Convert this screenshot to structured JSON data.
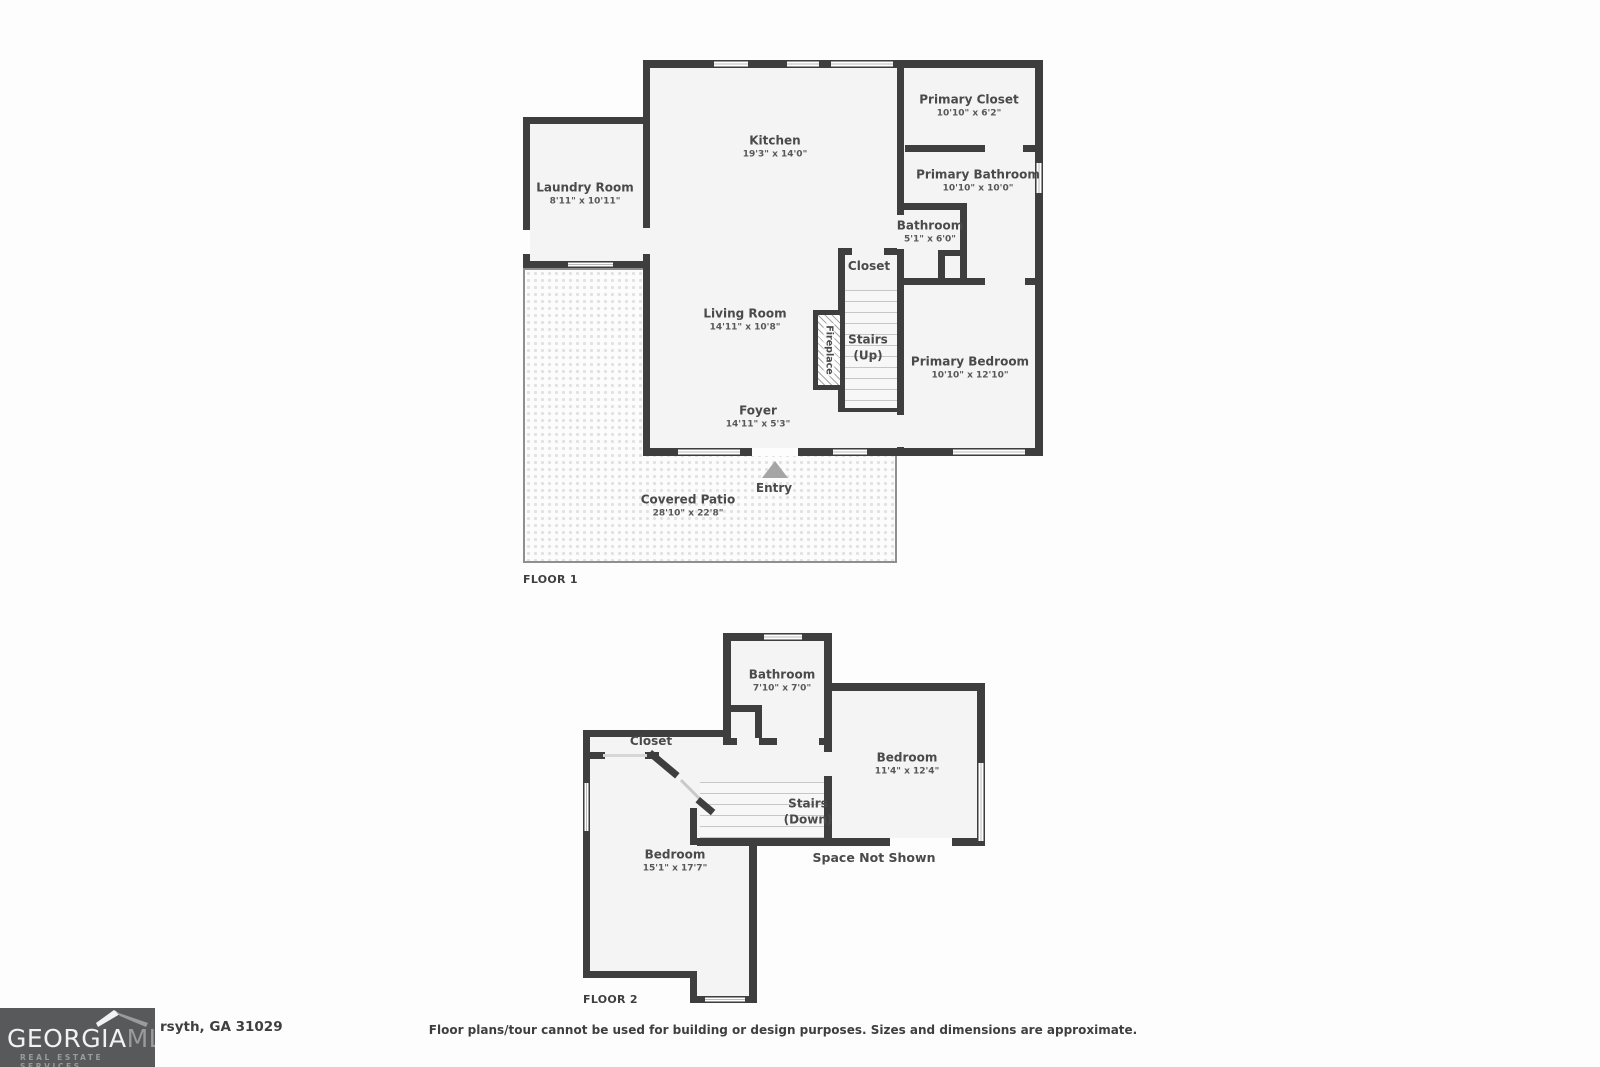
{
  "floor1": {
    "label": "FLOOR 1",
    "rooms": {
      "kitchen": {
        "name": "Kitchen",
        "dims": "19'3\" x 14'0\""
      },
      "laundry": {
        "name": "Laundry Room",
        "dims": "8'11\" x 10'11\""
      },
      "primary_closet": {
        "name": "Primary Closet",
        "dims": "10'10\" x 6'2\""
      },
      "primary_bathroom": {
        "name": "Primary Bathroom",
        "dims": "10'10\" x 10'0\""
      },
      "bathroom": {
        "name": "Bathroom",
        "dims": "5'1\" x 6'0\""
      },
      "closet": {
        "name": "Closet"
      },
      "living_room": {
        "name": "Living Room",
        "dims": "14'11\" x 10'8\""
      },
      "stairs": {
        "name": "Stairs",
        "sub": "(Up)"
      },
      "primary_bedroom": {
        "name": "Primary Bedroom",
        "dims": "10'10\" x 12'10\""
      },
      "fireplace": {
        "name": "Fireplace"
      },
      "foyer": {
        "name": "Foyer",
        "dims": "14'11\" x 5'3\""
      },
      "entry": {
        "name": "Entry"
      },
      "covered_patio": {
        "name": "Covered Patio",
        "dims": "28'10\" x 22'8\""
      }
    }
  },
  "floor2": {
    "label": "FLOOR 2",
    "rooms": {
      "bathroom": {
        "name": "Bathroom",
        "dims": "7'10\" x 7'0\""
      },
      "closet": {
        "name": "Closet"
      },
      "bedroom_right": {
        "name": "Bedroom",
        "dims": "11'4\" x 12'4\""
      },
      "stairs": {
        "name": "Stairs",
        "sub": "(Down)"
      },
      "bedroom_left": {
        "name": "Bedroom",
        "dims": "15'1\" x 17'7\""
      },
      "space_not_shown": {
        "name": "Space Not Shown"
      }
    }
  },
  "footer": {
    "address": "rsyth, GA 31029",
    "disclaimer": "Floor plans/tour cannot be used for building or design purposes. Sizes and dimensions are approximate."
  },
  "logo": {
    "line1a": "GEORGIA",
    "line1b": "MLS",
    "line2": "REAL ESTATE SERVICES"
  },
  "colors": {
    "wall": "#3e3e3e",
    "room_fill": "#f4f4f4",
    "logo_background": "#58595b",
    "text": "#4a4a4a"
  }
}
